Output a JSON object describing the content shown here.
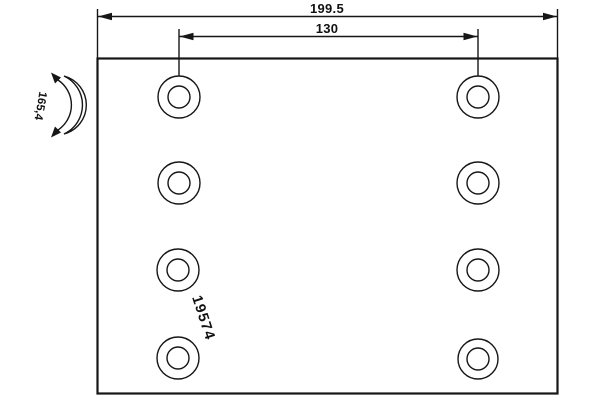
{
  "drawing": {
    "type": "brake-lining-technical-drawing",
    "background_color": "#ffffff",
    "line_color": "#161616",
    "part_number": "19574",
    "dimensions": {
      "overall_width": "199.5",
      "hole_spacing": "130",
      "arc_radius": "165,4"
    },
    "holes": {
      "count": 8,
      "columns": 2,
      "rows": 4
    }
  }
}
